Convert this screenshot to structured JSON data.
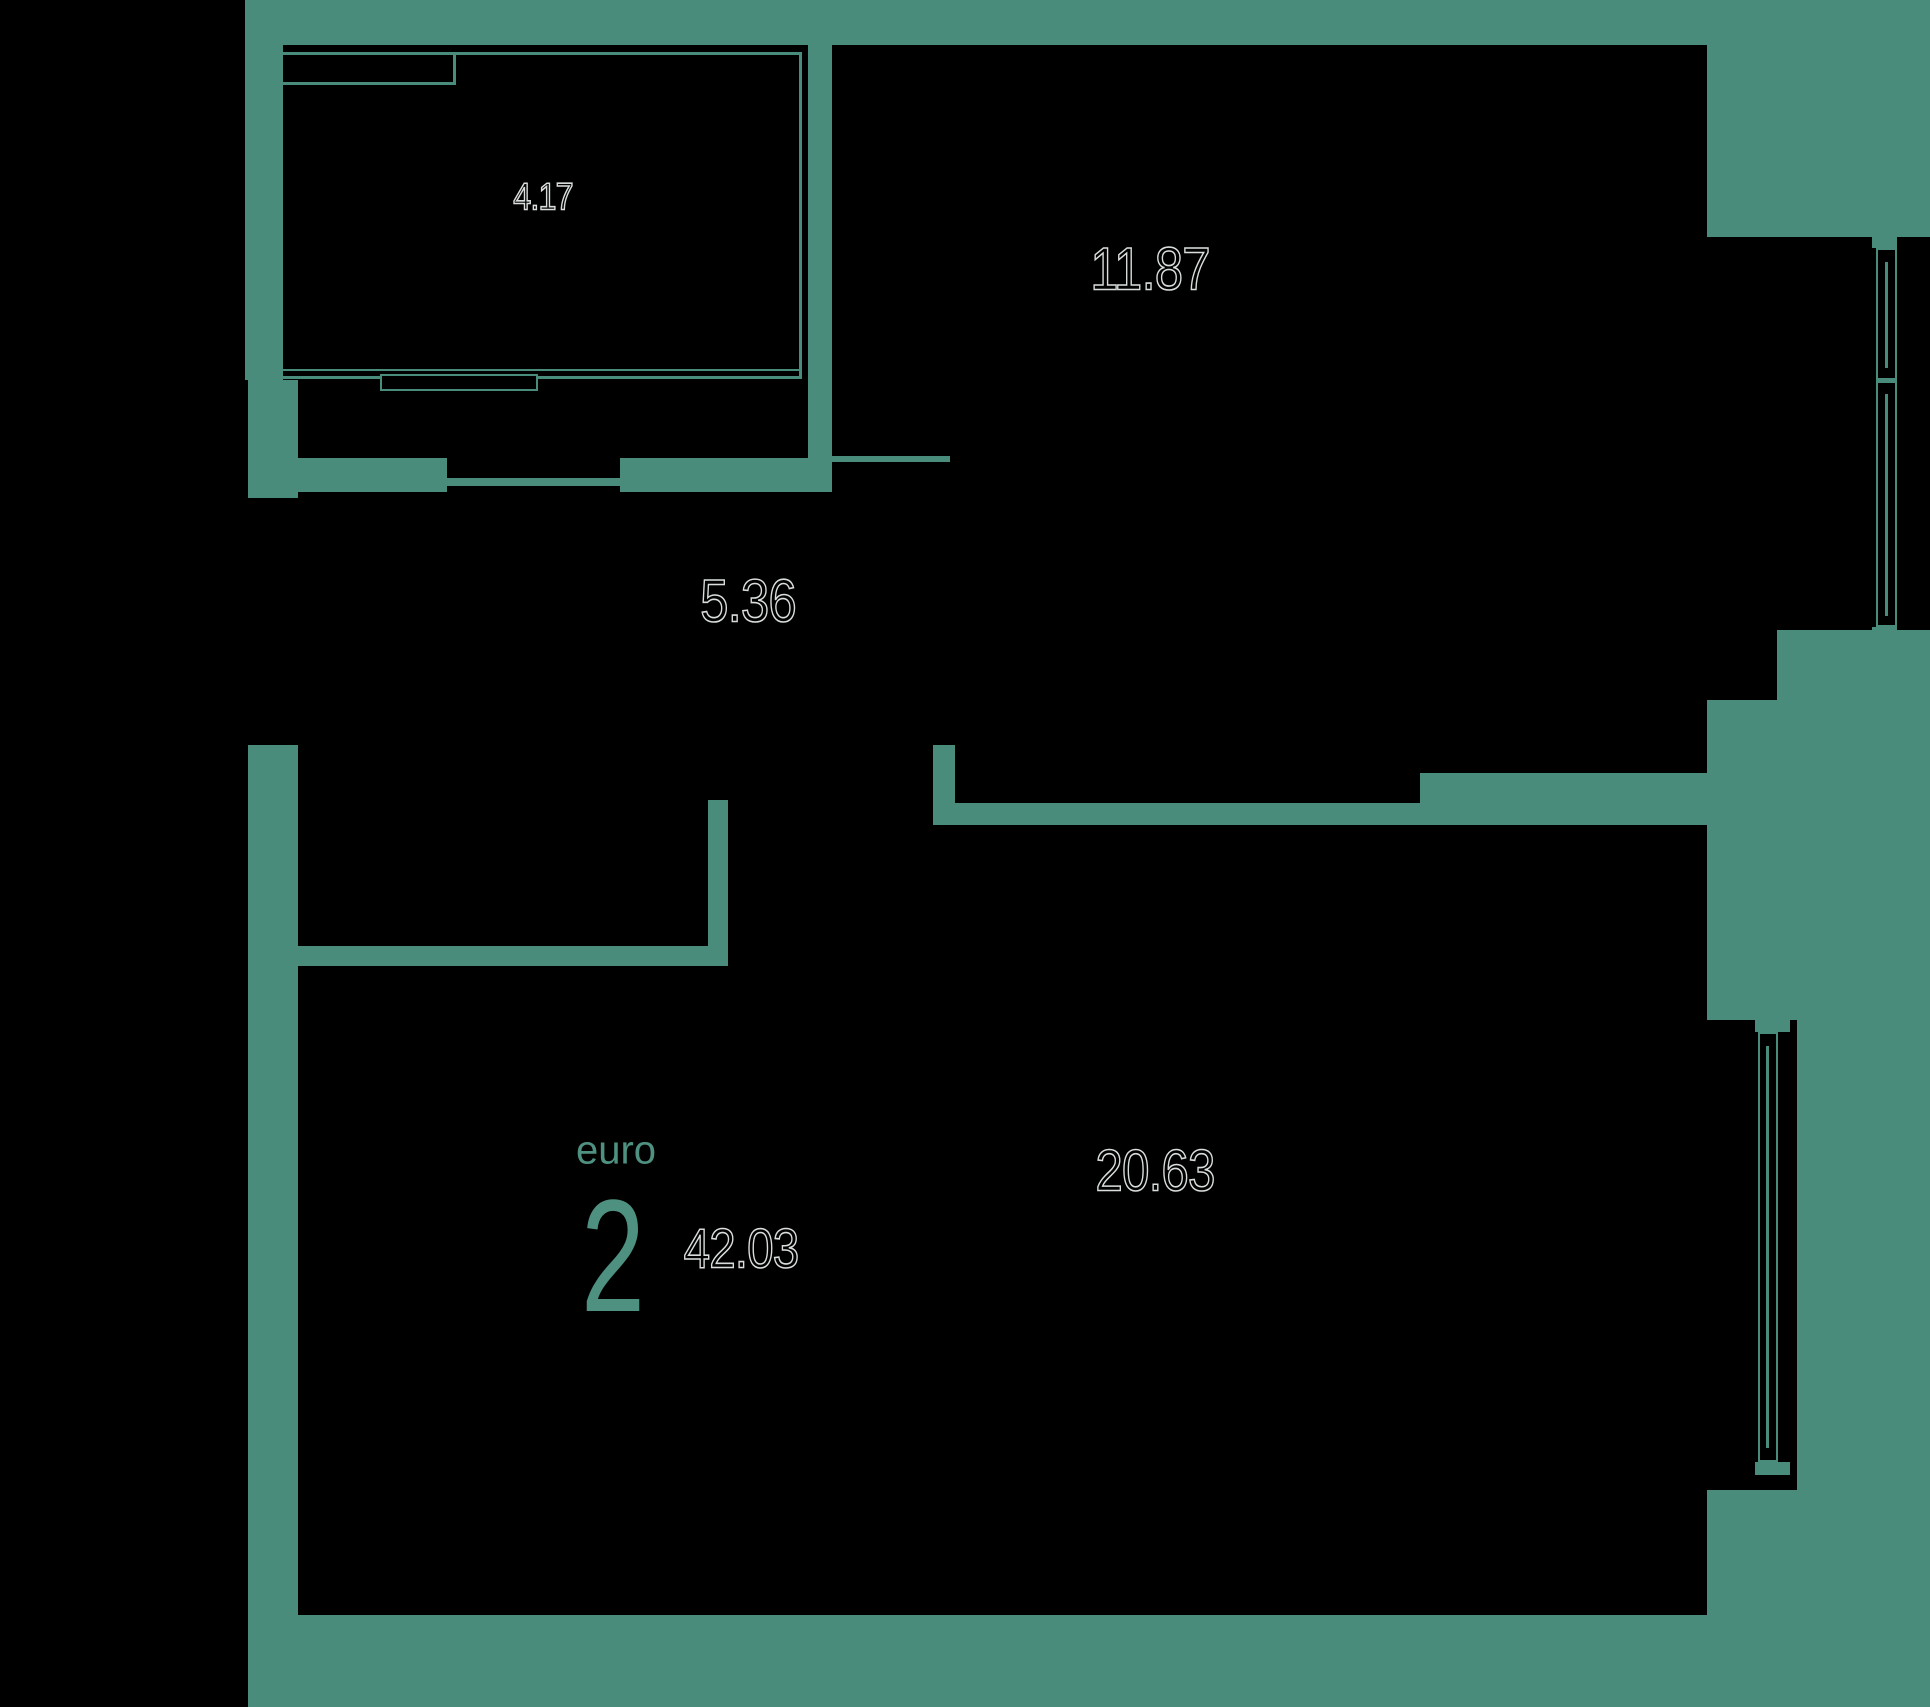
{
  "plan": {
    "unit": {
      "type_label": "euro",
      "type_number": "2",
      "total_area": "42.03"
    },
    "rooms": [
      {
        "name": "balcony",
        "area": "4.17"
      },
      {
        "name": "bedroom",
        "area": "11.87"
      },
      {
        "name": "hallway",
        "area": "5.36"
      },
      {
        "name": "living-kitchen",
        "area": "20.63"
      }
    ],
    "colors": {
      "wall": "#4a8c7b",
      "accent": "#4f9181",
      "digit_outline": "#d9dedd",
      "background": "#000000"
    }
  }
}
